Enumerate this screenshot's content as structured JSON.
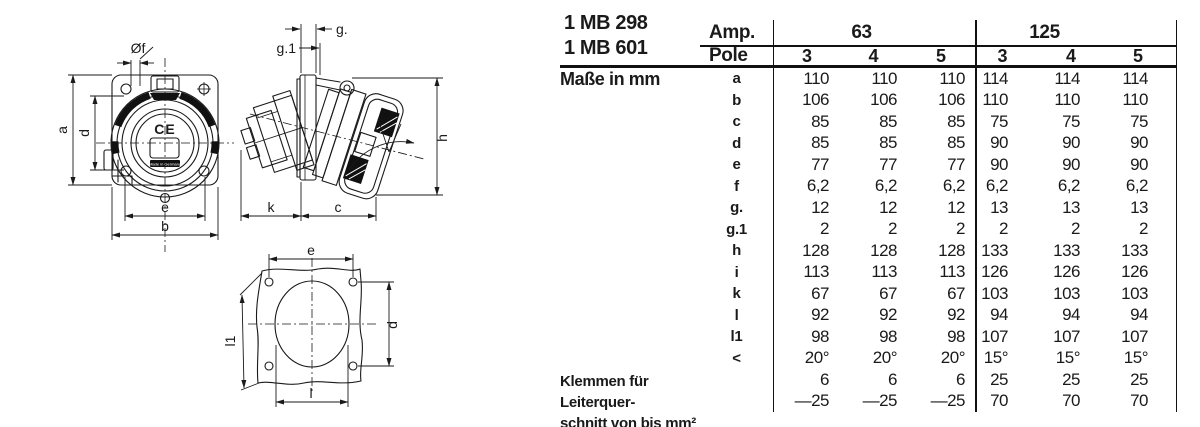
{
  "page": {
    "background": "#ffffff",
    "ink": "#1a1a1a"
  },
  "models": {
    "line1": "1 MB 298",
    "line2": "1 MB 601"
  },
  "table": {
    "amp_label": "Amp.",
    "pole_label": "Pole",
    "dimensions_label": "Maße in mm",
    "groups": [
      {
        "amp": "63",
        "poles": [
          "3",
          "4",
          "5"
        ]
      },
      {
        "amp": "125",
        "poles": [
          "3",
          "4",
          "5"
        ]
      }
    ],
    "rows": [
      {
        "key": "a",
        "values": [
          "110",
          "110",
          "110",
          "114",
          "114",
          "114"
        ]
      },
      {
        "key": "b",
        "values": [
          "106",
          "106",
          "106",
          "110",
          "110",
          "110"
        ]
      },
      {
        "key": "c",
        "values": [
          "85",
          "85",
          "85",
          "75",
          "75",
          "75"
        ]
      },
      {
        "key": "d",
        "values": [
          "85",
          "85",
          "85",
          "90",
          "90",
          "90"
        ]
      },
      {
        "key": "e",
        "values": [
          "77",
          "77",
          "77",
          "90",
          "90",
          "90"
        ]
      },
      {
        "key": "f",
        "values": [
          "6,2",
          "6,2",
          "6,2",
          "6,2",
          "6,2",
          "6,2"
        ]
      },
      {
        "key": "g.",
        "values": [
          "12",
          "12",
          "12",
          "13",
          "13",
          "13"
        ]
      },
      {
        "key": "g.1",
        "values": [
          "2",
          "2",
          "2",
          "2",
          "2",
          "2"
        ]
      },
      {
        "key": "h",
        "values": [
          "128",
          "128",
          "128",
          "133",
          "133",
          "133"
        ]
      },
      {
        "key": "i",
        "values": [
          "113",
          "113",
          "113",
          "126",
          "126",
          "126"
        ]
      },
      {
        "key": "k",
        "values": [
          "67",
          "67",
          "67",
          "103",
          "103",
          "103"
        ]
      },
      {
        "key": "l",
        "values": [
          "92",
          "92",
          "92",
          "94",
          "94",
          "94"
        ]
      },
      {
        "key": "l1",
        "values": [
          "98",
          "98",
          "98",
          "107",
          "107",
          "107"
        ]
      },
      {
        "key": "<",
        "values": [
          "20°",
          "20°",
          "20°",
          "15°",
          "15°",
          "15°"
        ]
      },
      {
        "key": "",
        "values": [
          "6",
          "6",
          "6",
          "25",
          "25",
          "25"
        ]
      },
      {
        "key": "",
        "values": [
          "—25",
          "—25",
          "—25",
          "70",
          "70",
          "70"
        ]
      }
    ],
    "terminal_label_line1": "Klemmen für Leiterquer-",
    "terminal_label_line2": "schnitt von bis mm²"
  },
  "drawings": {
    "front_view": {
      "dia_label": "Øf",
      "a": "a",
      "d": "d",
      "e": "e",
      "b": "b",
      "ce_mark": "CE",
      "made_in": "Made in Germany"
    },
    "side_view": {
      "g": "g.",
      "g1": "g.1",
      "h": "h",
      "k": "k",
      "c": "c"
    },
    "cutout_view": {
      "e": "e",
      "d": "d",
      "l1": "l1",
      "l": "l"
    }
  }
}
